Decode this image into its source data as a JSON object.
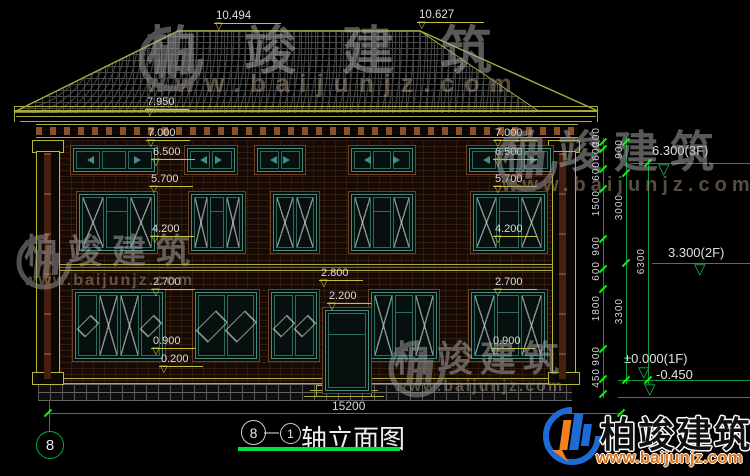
{
  "meta": {
    "bubble_left": "8",
    "separator": "—",
    "bubble_right": "1",
    "title": "轴立面图"
  },
  "axis": {
    "bubble": "8"
  },
  "dims": {
    "ridge_left": "10.494",
    "ridge_right": "10.627",
    "eave": "7.950",
    "levels_left": [
      "7.000",
      "6.500",
      "5.700",
      "4.200",
      "2.700",
      "0.900",
      "0.200"
    ],
    "levels_right": [
      "7.000",
      "6.500",
      "5.700",
      "4.200",
      "2.700",
      "0.900"
    ],
    "door": [
      "2.800",
      "2.200"
    ],
    "total_width": "15200",
    "chain_small": [
      "200",
      "600",
      "600",
      "1500",
      "900",
      "600",
      "1800",
      "900",
      "450"
    ],
    "chain_mid": [
      "900",
      "3000",
      "3300"
    ],
    "chain_total": [
      "6300"
    ],
    "level_marks": [
      "6.300(3F)",
      "3.300(2F)",
      "±0.000(1F)",
      "-0.450"
    ]
  },
  "brand": {
    "name": "柏竣建筑",
    "url": "www.baijunjz.com"
  },
  "icons": {
    "dim_arrow": "▽",
    "level_arrow": "▽"
  },
  "colors": {
    "outline": "#a9a940",
    "dim_line": "#c3c33e",
    "axis_green": "#089a3c",
    "tick_green": "#00ff00",
    "window_teal": "#3f8f84",
    "surround_brown": "#6b4226",
    "title_underline": "#00dd48",
    "logo_blue": "#1e6bd6",
    "logo_orange": "#f08020"
  }
}
